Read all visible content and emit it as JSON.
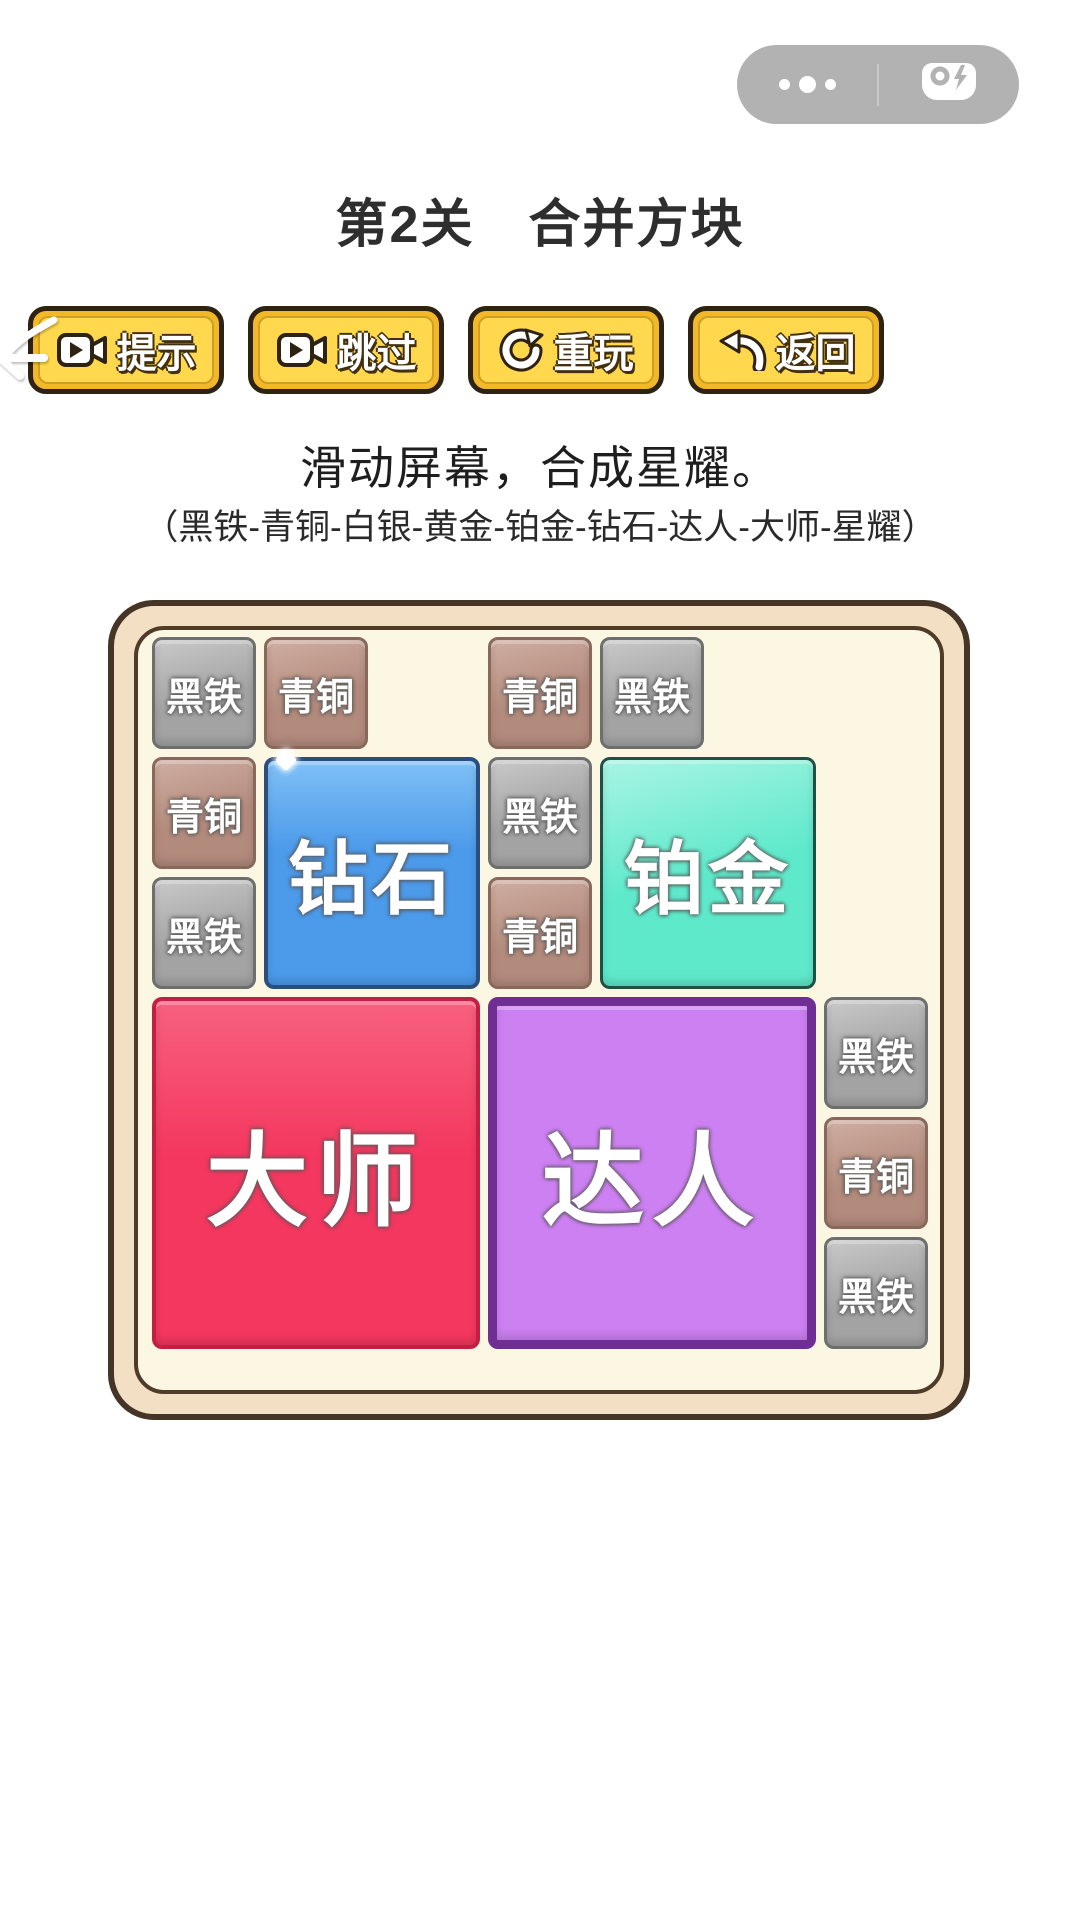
{
  "capsule": {
    "background": "#B2B2B2",
    "more_icon": "more-dots-icon",
    "game_icon": "gamepad-icon"
  },
  "header": {
    "title": "第2关　合并方块"
  },
  "toolbar": {
    "button_fill": "#FFD84E",
    "button_border": "#2E2213",
    "buttons": [
      {
        "id": "hint",
        "label": "提示",
        "icon": "video-ad-icon"
      },
      {
        "id": "skip",
        "label": "跳过",
        "icon": "video-ad-icon"
      },
      {
        "id": "replay",
        "label": "重玩",
        "icon": "refresh-icon"
      },
      {
        "id": "back",
        "label": "返回",
        "icon": "back-arrow-icon"
      }
    ]
  },
  "instructions": {
    "main": "滑动屏幕，合成星耀。",
    "rank_order": "（黑铁-青铜-白银-黄金-铂金-钻石-达人-大师-星耀）"
  },
  "board": {
    "frame_fill": "#F3DFC3",
    "frame_border": "#463426",
    "inner_fill": "#FCF7E3",
    "grid": {
      "cols": 7,
      "rows": 6
    },
    "tiers": {
      "iron": {
        "label": "黑铁",
        "fill": "#A3A3A3",
        "highlight": "#C9C9C9",
        "border": "#6E6E6E"
      },
      "bronze": {
        "label": "青铜",
        "fill": "#B38B7D",
        "highlight": "#CFAEA2",
        "border": "#8A675B"
      },
      "diamond": {
        "label": "钻石",
        "fill": "#4C9AEA",
        "highlight": "#7FC0F6",
        "border": "#2C4E7C"
      },
      "platinum": {
        "label": "铂金",
        "fill": "#5FE9CB",
        "highlight": "#A9F4E4",
        "border": "#1F4F45"
      },
      "expert": {
        "label": "达人",
        "fill": "#CD80F2",
        "highlight": "#DFA3F8",
        "border": "#6F2E93"
      },
      "master": {
        "label": "大师",
        "fill": "#F4375F",
        "highlight": "#F8607F",
        "border": "#C21F45"
      }
    },
    "blocks": [
      {
        "tier": "iron",
        "col": 0,
        "row": 0,
        "w": 1,
        "h": 1
      },
      {
        "tier": "bronze",
        "col": 1,
        "row": 0,
        "w": 1,
        "h": 1
      },
      {
        "tier": "bronze",
        "col": 3,
        "row": 0,
        "w": 1,
        "h": 1
      },
      {
        "tier": "iron",
        "col": 4,
        "row": 0,
        "w": 1,
        "h": 1
      },
      {
        "tier": "bronze",
        "col": 0,
        "row": 1,
        "w": 1,
        "h": 1
      },
      {
        "tier": "diamond",
        "col": 1,
        "row": 1,
        "w": 2,
        "h": 2
      },
      {
        "tier": "iron",
        "col": 3,
        "row": 1,
        "w": 1,
        "h": 1
      },
      {
        "tier": "platinum",
        "col": 4,
        "row": 1,
        "w": 2,
        "h": 2
      },
      {
        "tier": "iron",
        "col": 0,
        "row": 2,
        "w": 1,
        "h": 1
      },
      {
        "tier": "bronze",
        "col": 3,
        "row": 2,
        "w": 1,
        "h": 1
      },
      {
        "tier": "master",
        "col": 0,
        "row": 3,
        "w": 3,
        "h": 3
      },
      {
        "tier": "expert",
        "col": 3,
        "row": 3,
        "w": 3,
        "h": 3
      },
      {
        "tier": "iron",
        "col": 6,
        "row": 3,
        "w": 1,
        "h": 1
      },
      {
        "tier": "bronze",
        "col": 6,
        "row": 4,
        "w": 1,
        "h": 1
      },
      {
        "tier": "iron",
        "col": 6,
        "row": 5,
        "w": 1,
        "h": 1
      }
    ]
  }
}
